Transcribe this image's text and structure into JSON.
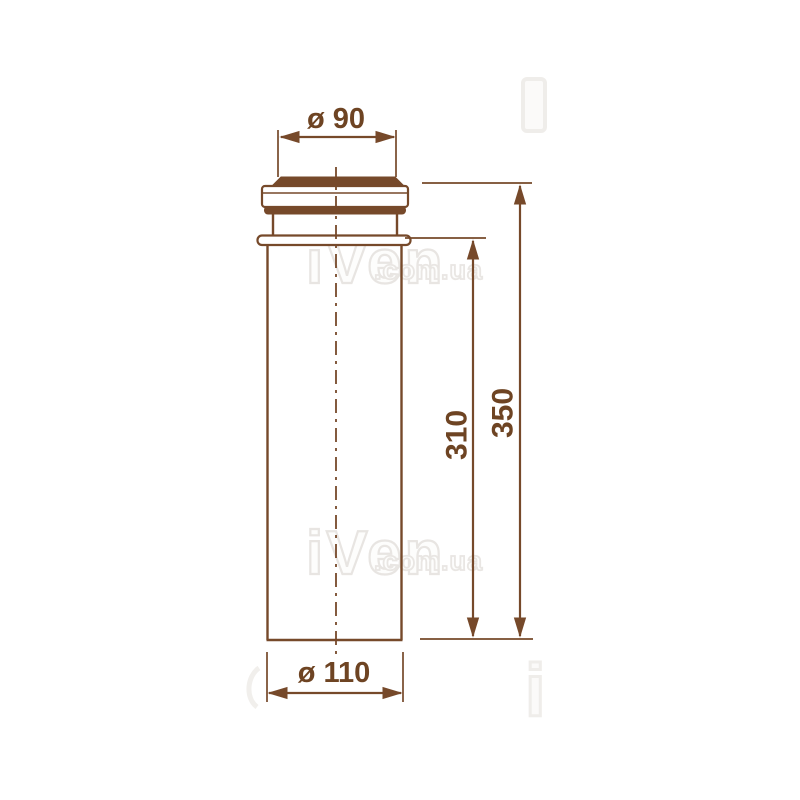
{
  "drawing": {
    "dims": {
      "top_diameter": "ø 90",
      "bottom_diameter": "ø 110",
      "inner_height": "310",
      "overall_height": "350"
    },
    "colors": {
      "line": "#76492a",
      "dim_text": "#6e4423",
      "watermark": "#e8e5e2",
      "background": "#ffffff"
    },
    "watermark": {
      "brand": "iVen",
      "suffix": ".com.ua",
      "fragment_letter": "i"
    }
  }
}
